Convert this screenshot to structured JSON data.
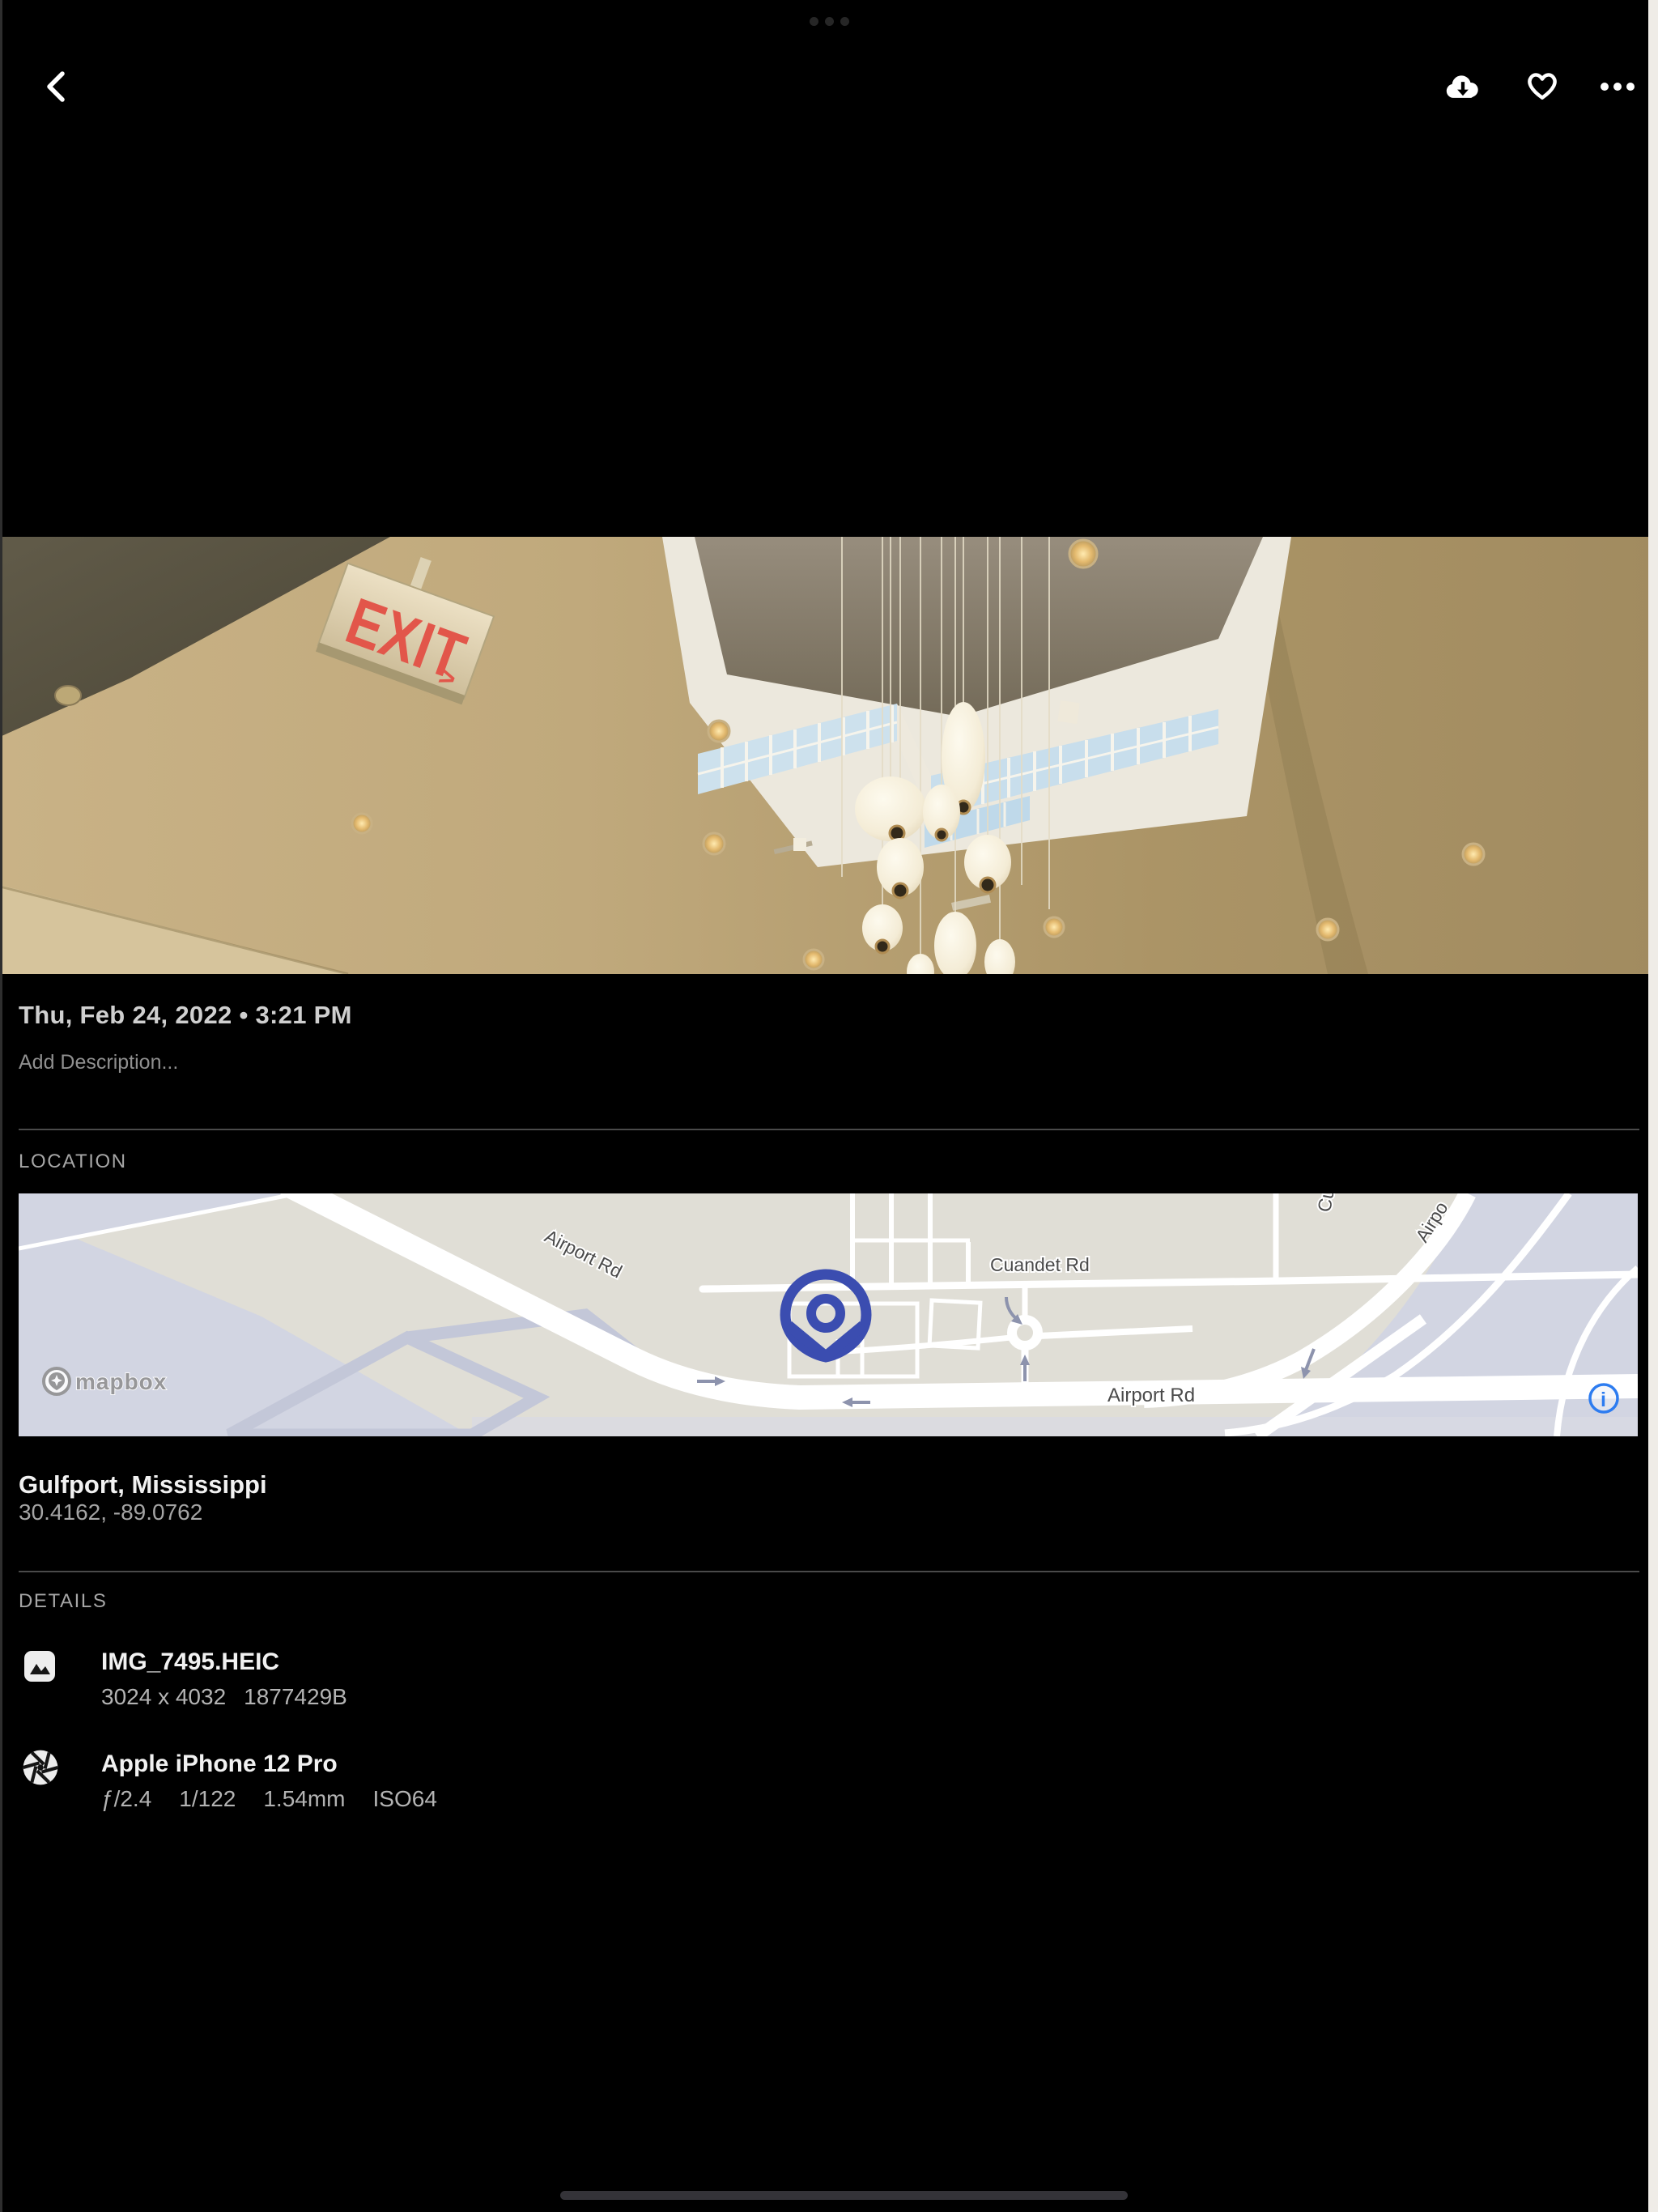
{
  "status_bar": {
    "multitask_indicator": "•••"
  },
  "toolbar": {
    "back_icon": "chevron-left",
    "download_icon": "cloud-download",
    "favorite_icon": "heart-outline",
    "more_icon": "ellipsis"
  },
  "photo": {
    "exit_text": "EXIT",
    "exit_arrow": ">"
  },
  "info": {
    "date": "Thu, Feb 24, 2022 • 3:21 PM",
    "description_placeholder": "Add Description..."
  },
  "location": {
    "section_label": "LOCATION",
    "place": "Gulfport, Mississippi",
    "coordinates": "30.4162, -89.0762",
    "map": {
      "labels": {
        "airport_rd_diagonal": "Airport Rd",
        "cuandet_rd": "Cuandet Rd",
        "airport_rd_bottom": "Airport Rd",
        "airport_partial": "Airpo",
        "cu_partial": "Cu"
      },
      "mapbox_label": "mapbox",
      "info_glyph": "i",
      "pin_color": "#3b4db0",
      "info_color": "#2d7cf0",
      "land_color": "#e0ded6",
      "zone_color": "#d2d5e2"
    }
  },
  "details": {
    "section_label": "DETAILS",
    "file": {
      "name": "IMG_7495.HEIC",
      "dimensions": "3024 x 4032",
      "size": "1877429B"
    },
    "camera": {
      "name": "Apple iPhone 12 Pro",
      "aperture": "ƒ/2.4",
      "shutter": "1/122",
      "focal_length": "1.54mm",
      "iso": "ISO64"
    }
  }
}
